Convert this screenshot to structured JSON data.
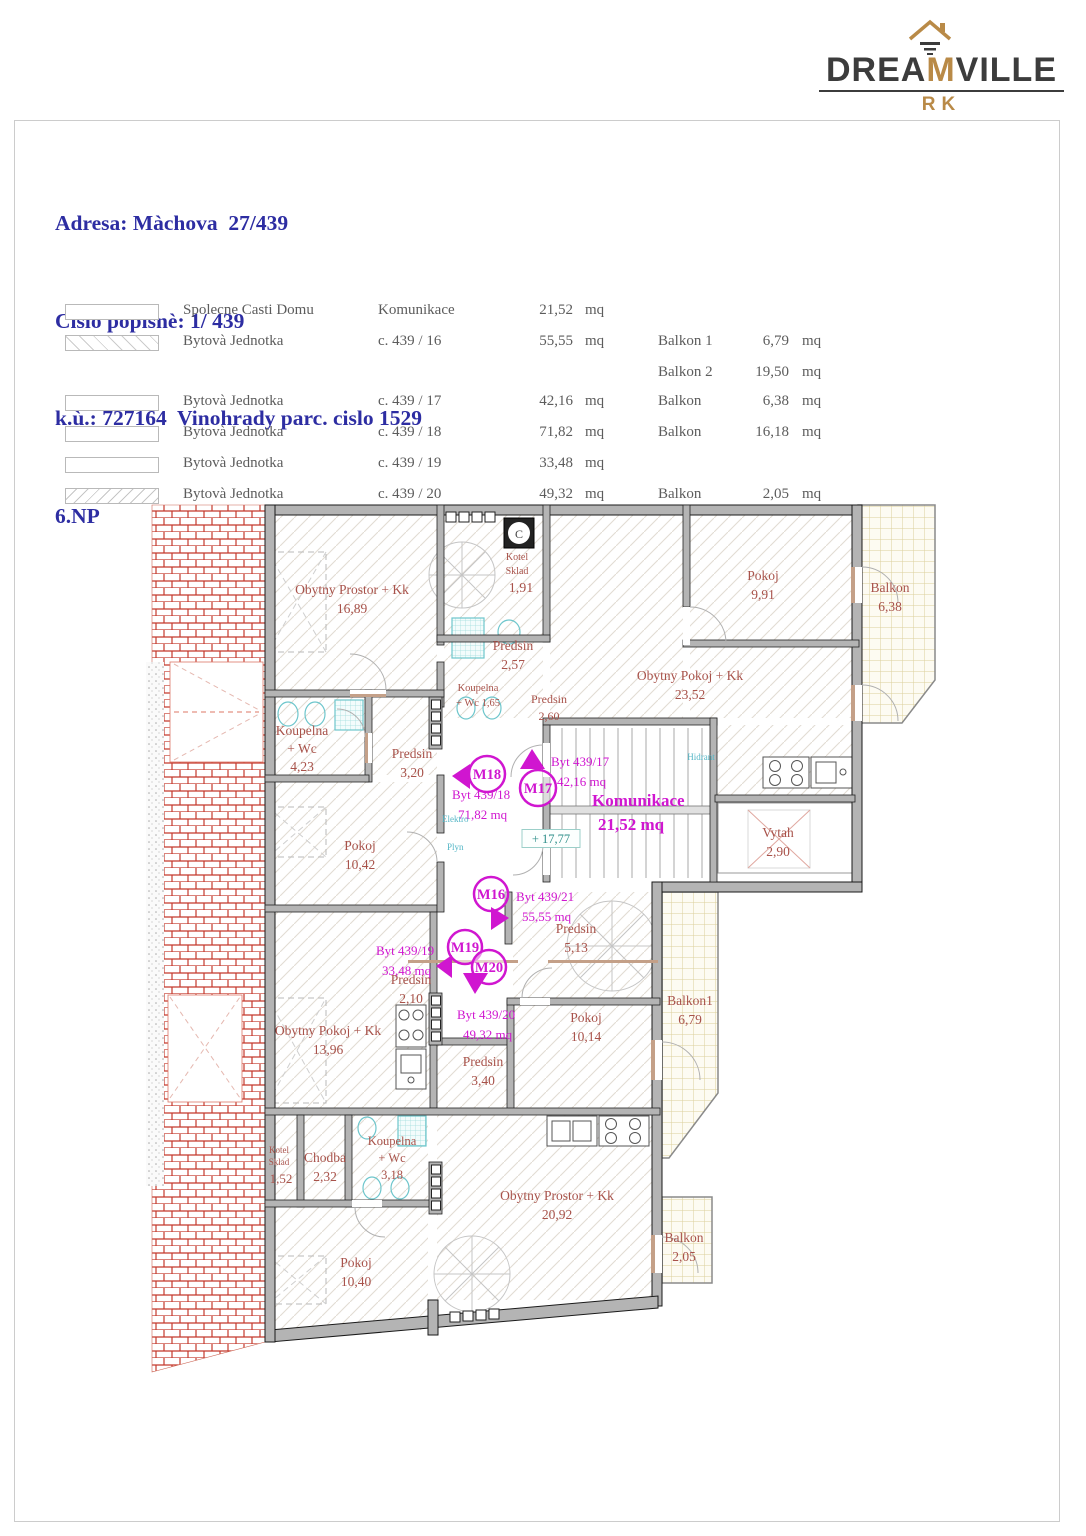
{
  "brand": {
    "prefix": "DREA",
    "accent": "M",
    "suffix": "VILLE",
    "subtitle": "RK"
  },
  "title_block": {
    "address": "Adresa: Màchova  27/439",
    "house_number": "Cislo popisnè: 1/ 439",
    "cadastre": "k.ù.: 727164  Vinohrady parc. cislo 1529",
    "floor": "6.NP"
  },
  "legend": {
    "rows": [
      {
        "swatch": "plain",
        "col1": "Spolecne Casti Domu",
        "col2": "Komunikace",
        "area": "21,52",
        "unit": "mq",
        "balconies": []
      },
      {
        "swatch": "hatch-back",
        "col1": "Bytovà  Jednotka",
        "col2": "c. 439 / 16",
        "area": "55,55",
        "unit": "mq",
        "balconies": [
          {
            "label": "Balkon 1",
            "area": "6,79",
            "unit": "mq"
          },
          {
            "label": "Balkon 2",
            "area": "19,50",
            "unit": "mq"
          }
        ]
      },
      {
        "swatch": "plain",
        "col1": "Bytovà  Jednotka",
        "col2": "c. 439 / 17",
        "area": "42,16",
        "unit": "mq",
        "balconies": [
          {
            "label": "Balkon",
            "area": "6,38",
            "unit": "mq"
          }
        ]
      },
      {
        "swatch": "plain",
        "col1": "Bytovà  Jednotka",
        "col2": "c. 439 / 18",
        "area": "71,82",
        "unit": "mq",
        "balconies": [
          {
            "label": "Balkon",
            "area": "16,18",
            "unit": "mq"
          }
        ]
      },
      {
        "swatch": "plain",
        "col1": "Bytovà  Jednotka",
        "col2": "c. 439 / 19",
        "area": "33,48",
        "unit": "mq",
        "balconies": []
      },
      {
        "swatch": "hatch-fwd",
        "col1": "Bytovà  Jednotka",
        "col2": "c. 439 / 20",
        "area": "49,32",
        "unit": "mq",
        "balconies": [
          {
            "label": "Balkon",
            "area": "2,05",
            "unit": "mq"
          }
        ]
      }
    ]
  },
  "plan": {
    "room_labels": [
      {
        "lines": [
          "Obytny Prostor + Kk",
          "16,89"
        ],
        "x": 352,
        "y": 594
      },
      {
        "lines": [
          "Kotel",
          "Sklad"
        ],
        "x": 517,
        "y": 560,
        "fs": 10,
        "lh": 14
      },
      {
        "lines": [
          "1,91"
        ],
        "x": 521,
        "y": 592,
        "fs": 14
      },
      {
        "lines": [
          "Pokoj",
          "9,91"
        ],
        "x": 763,
        "y": 580
      },
      {
        "lines": [
          "Balkon",
          "6,38"
        ],
        "x": 890,
        "y": 592
      },
      {
        "lines": [
          "Predsin",
          "2,57"
        ],
        "x": 513,
        "y": 650
      },
      {
        "lines": [
          "Koupelna",
          "+ Wc 1,65"
        ],
        "x": 478,
        "y": 691,
        "fs": 10.5,
        "lh": 15
      },
      {
        "lines": [
          "Predsin",
          "2,60"
        ],
        "x": 549,
        "y": 703,
        "fs": 12,
        "lh": 17
      },
      {
        "lines": [
          "Obytny Pokoj + Kk",
          "23,52"
        ],
        "x": 690,
        "y": 680
      },
      {
        "lines": [
          "Koupelna",
          "+ Wc",
          "4,23"
        ],
        "x": 302,
        "y": 735,
        "lh": 18
      },
      {
        "lines": [
          "Predsin",
          "3,20"
        ],
        "x": 412,
        "y": 758
      },
      {
        "lines": [
          "Pokoj",
          "10,42"
        ],
        "x": 360,
        "y": 850
      },
      {
        "lines": [
          "Vytah",
          "2,90"
        ],
        "x": 778,
        "y": 837
      },
      {
        "lines": [
          "Predsin",
          "5,13"
        ],
        "x": 576,
        "y": 933
      },
      {
        "lines": [
          "Predsin",
          "2,10"
        ],
        "x": 411,
        "y": 984
      },
      {
        "lines": [
          "Obytny Pokoj + Kk",
          "13,96"
        ],
        "x": 328,
        "y": 1035
      },
      {
        "lines": [
          "Pokoj",
          "10,14"
        ],
        "x": 586,
        "y": 1022
      },
      {
        "lines": [
          "Balkon1",
          "6,79"
        ],
        "x": 690,
        "y": 1005
      },
      {
        "lines": [
          "Predsin",
          "3,40"
        ],
        "x": 483,
        "y": 1066
      },
      {
        "lines": [
          "Kotel",
          "Sklad"
        ],
        "x": 279,
        "y": 1153,
        "fs": 9,
        "lh": 12
      },
      {
        "lines": [
          "1,52"
        ],
        "x": 281,
        "y": 1183,
        "fs": 13
      },
      {
        "lines": [
          "Chodba",
          "2,32"
        ],
        "x": 325,
        "y": 1162
      },
      {
        "lines": [
          "Koupelna",
          "+ Wc",
          "3,18"
        ],
        "x": 392,
        "y": 1145,
        "fs": 12.5,
        "lh": 17
      },
      {
        "lines": [
          "Obytny Prostor + Kk",
          "20,92"
        ],
        "x": 557,
        "y": 1200
      },
      {
        "lines": [
          "Pokoj",
          "10,40"
        ],
        "x": 356,
        "y": 1267
      },
      {
        "lines": [
          "Balkon",
          "2,05"
        ],
        "x": 684,
        "y": 1242
      }
    ],
    "unit_labels": [
      {
        "lines": [
          "Byt 439/17",
          "42,16 mq"
        ],
        "x": 551,
        "y": 766
      },
      {
        "lines": [
          "Byt 439/18",
          "71,82 mq"
        ],
        "x": 452,
        "y": 799
      },
      {
        "lines": [
          "Komunikace",
          "21,52  mq"
        ],
        "x": 592,
        "y": 806,
        "fs": 17,
        "bold": true,
        "lh": 24
      },
      {
        "lines": [
          "Byt 439/21",
          "55,55  mq"
        ],
        "x": 516,
        "y": 901
      },
      {
        "lines": [
          "Byt 439/19",
          "33,48 mq"
        ],
        "x": 376,
        "y": 955
      },
      {
        "lines": [
          "Byt 439/20",
          "49,32 mq"
        ],
        "x": 457,
        "y": 1019
      }
    ],
    "tech_labels": [
      {
        "t": "Hidrant",
        "x": 701,
        "y": 760,
        "fs": 9,
        "color": "#54b6c6",
        "anchor": "middle"
      },
      {
        "t": "Elektro",
        "x": 442,
        "y": 822,
        "fs": 9,
        "color": "#54b6c6",
        "anchor": "start"
      },
      {
        "t": "Plyn",
        "x": 447,
        "y": 850,
        "fs": 9,
        "color": "#54b6c6",
        "anchor": "start"
      },
      {
        "t": "+ 17,77",
        "x": 551,
        "y": 843,
        "fs": 12.5,
        "color": "#2e8f8a",
        "anchor": "middle",
        "box": true
      },
      {
        "t": "C",
        "x": 519,
        "y": 538,
        "fs": 12,
        "color": "#444444",
        "anchor": "middle"
      }
    ],
    "markers": [
      {
        "id": "M18",
        "cx": 487,
        "cy": 774,
        "r": 18,
        "tri": "452,776 470,764 470,789"
      },
      {
        "id": "M17",
        "cx": 538,
        "cy": 788,
        "r": 18,
        "tri": "532,749 520,769 545,769"
      },
      {
        "id": "M16",
        "cx": 491,
        "cy": 894,
        "r": 17,
        "tri": "509,918 491,907 491,930"
      },
      {
        "id": "M19",
        "cx": 465,
        "cy": 947,
        "r": 17,
        "tri": "436,966 452,955 452,978"
      },
      {
        "id": "M20",
        "cx": 489,
        "cy": 967,
        "r": 17,
        "tri": "475,994 463,973 488,973"
      }
    ]
  },
  "colors": {
    "accent_gold": "#b98a47",
    "header_blue": "#2d2da2",
    "room_label": "#a8524a",
    "unit_magenta": "#d016d0",
    "tech_cyan": "#54b6c6",
    "wall_gray": "#b4b4b4",
    "roof_red": "#c4392c",
    "balcony_line": "#dbcf9b"
  }
}
